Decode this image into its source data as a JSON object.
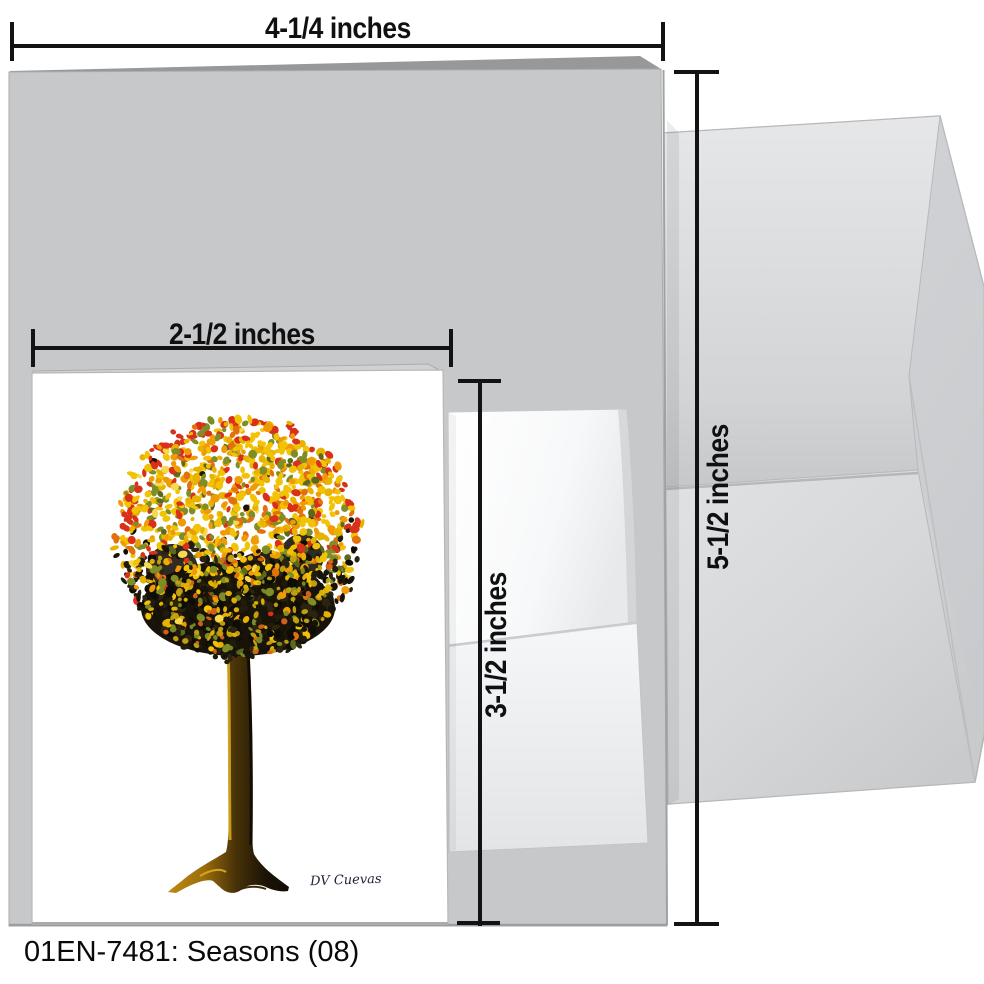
{
  "product": {
    "caption": "01EN-7481: Seasons (08)"
  },
  "measurements": {
    "card_width": "4-1/4 inches",
    "card_height": "5-1/2 inches",
    "insert_width": "2-1/2 inches",
    "insert_height": "3-1/2 inches"
  },
  "artwork": {
    "title_hint": "round autumn tree, pointillist dots",
    "signature": "DV Cuevas",
    "canopy": {
      "cx": 238,
      "cy": 537,
      "r": 121,
      "bright_palette": [
        [
          "#f2c204",
          30
        ],
        [
          "#e7b300",
          12
        ],
        [
          "#f09a05",
          15
        ],
        [
          "#e2700c",
          8
        ],
        [
          "#d93019",
          13
        ],
        [
          "#7e8d26",
          13
        ],
        [
          "#5c681b",
          5
        ],
        [
          "#f6d94e",
          4
        ]
      ],
      "dark_palette": [
        "#171309",
        "#211b0c",
        "#0e0c06",
        "#2c240f"
      ],
      "accent_palette": [
        "#e8b804",
        "#c3a80e",
        "#7d8c26",
        "#d9641a",
        "#caa312"
      ],
      "edge_red": "#d93019"
    },
    "trunk_colors": [
      "#c08a12",
      "#9a6c0c",
      "#4a3408",
      "#1c1406",
      "#100c04"
    ]
  },
  "colors": {
    "card_gray": "#c7c8ca",
    "card_back_edge": "#96989a",
    "envelope_gray": "#d6d8da",
    "small_envelope": "#ffffff",
    "small_card": "#ffffff",
    "dimension_line": "#131313",
    "caption_text": "#0a0a0a"
  }
}
